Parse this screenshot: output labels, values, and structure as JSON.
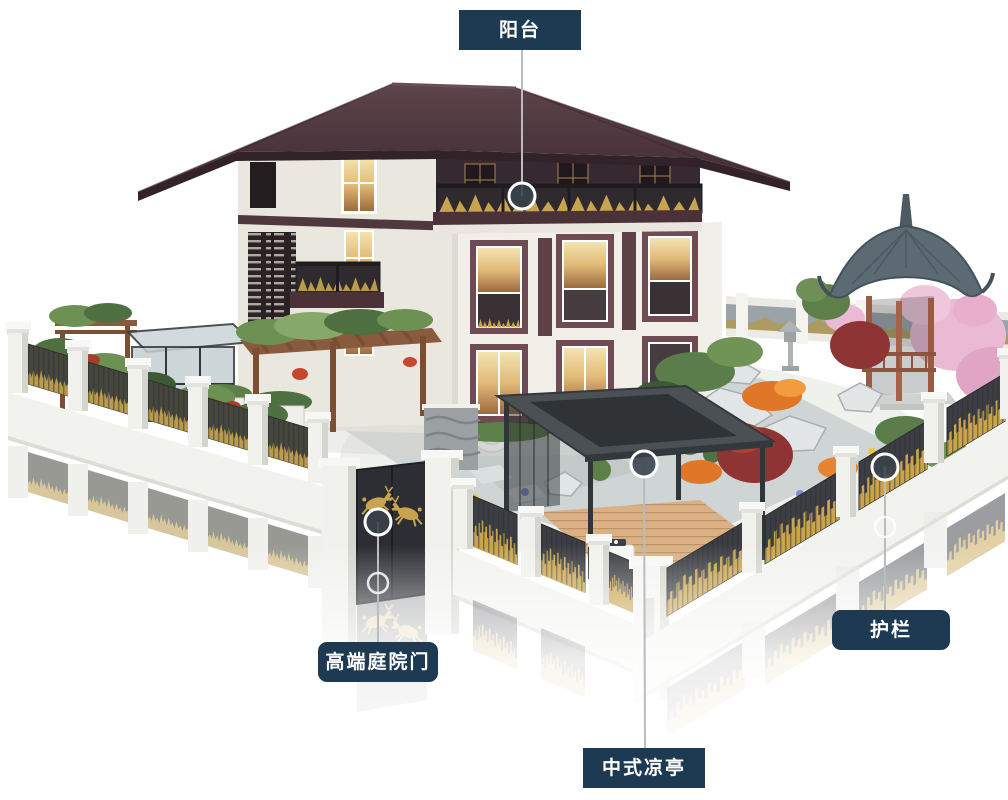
{
  "callouts": {
    "balcony": {
      "label": "阳台"
    },
    "gate": {
      "label": "高端庭院门"
    },
    "pavilion": {
      "label": "中式凉亭"
    },
    "guardrail": {
      "label": "护栏"
    }
  },
  "colors": {
    "callout_bg": "#1e3a53",
    "callout_text": "#ffffff",
    "leader_line": "#b9bdc0",
    "hotspot_fill": "#39424c",
    "hotspot_ring": "#ffffff",
    "gold_accent": "#c8a44e",
    "roof_maroon": "#4b343b",
    "wall_white": "#f1eee7",
    "fence_panel_dark": "#3c3e43",
    "pavilion_roof_gray": "#5b6a73"
  }
}
